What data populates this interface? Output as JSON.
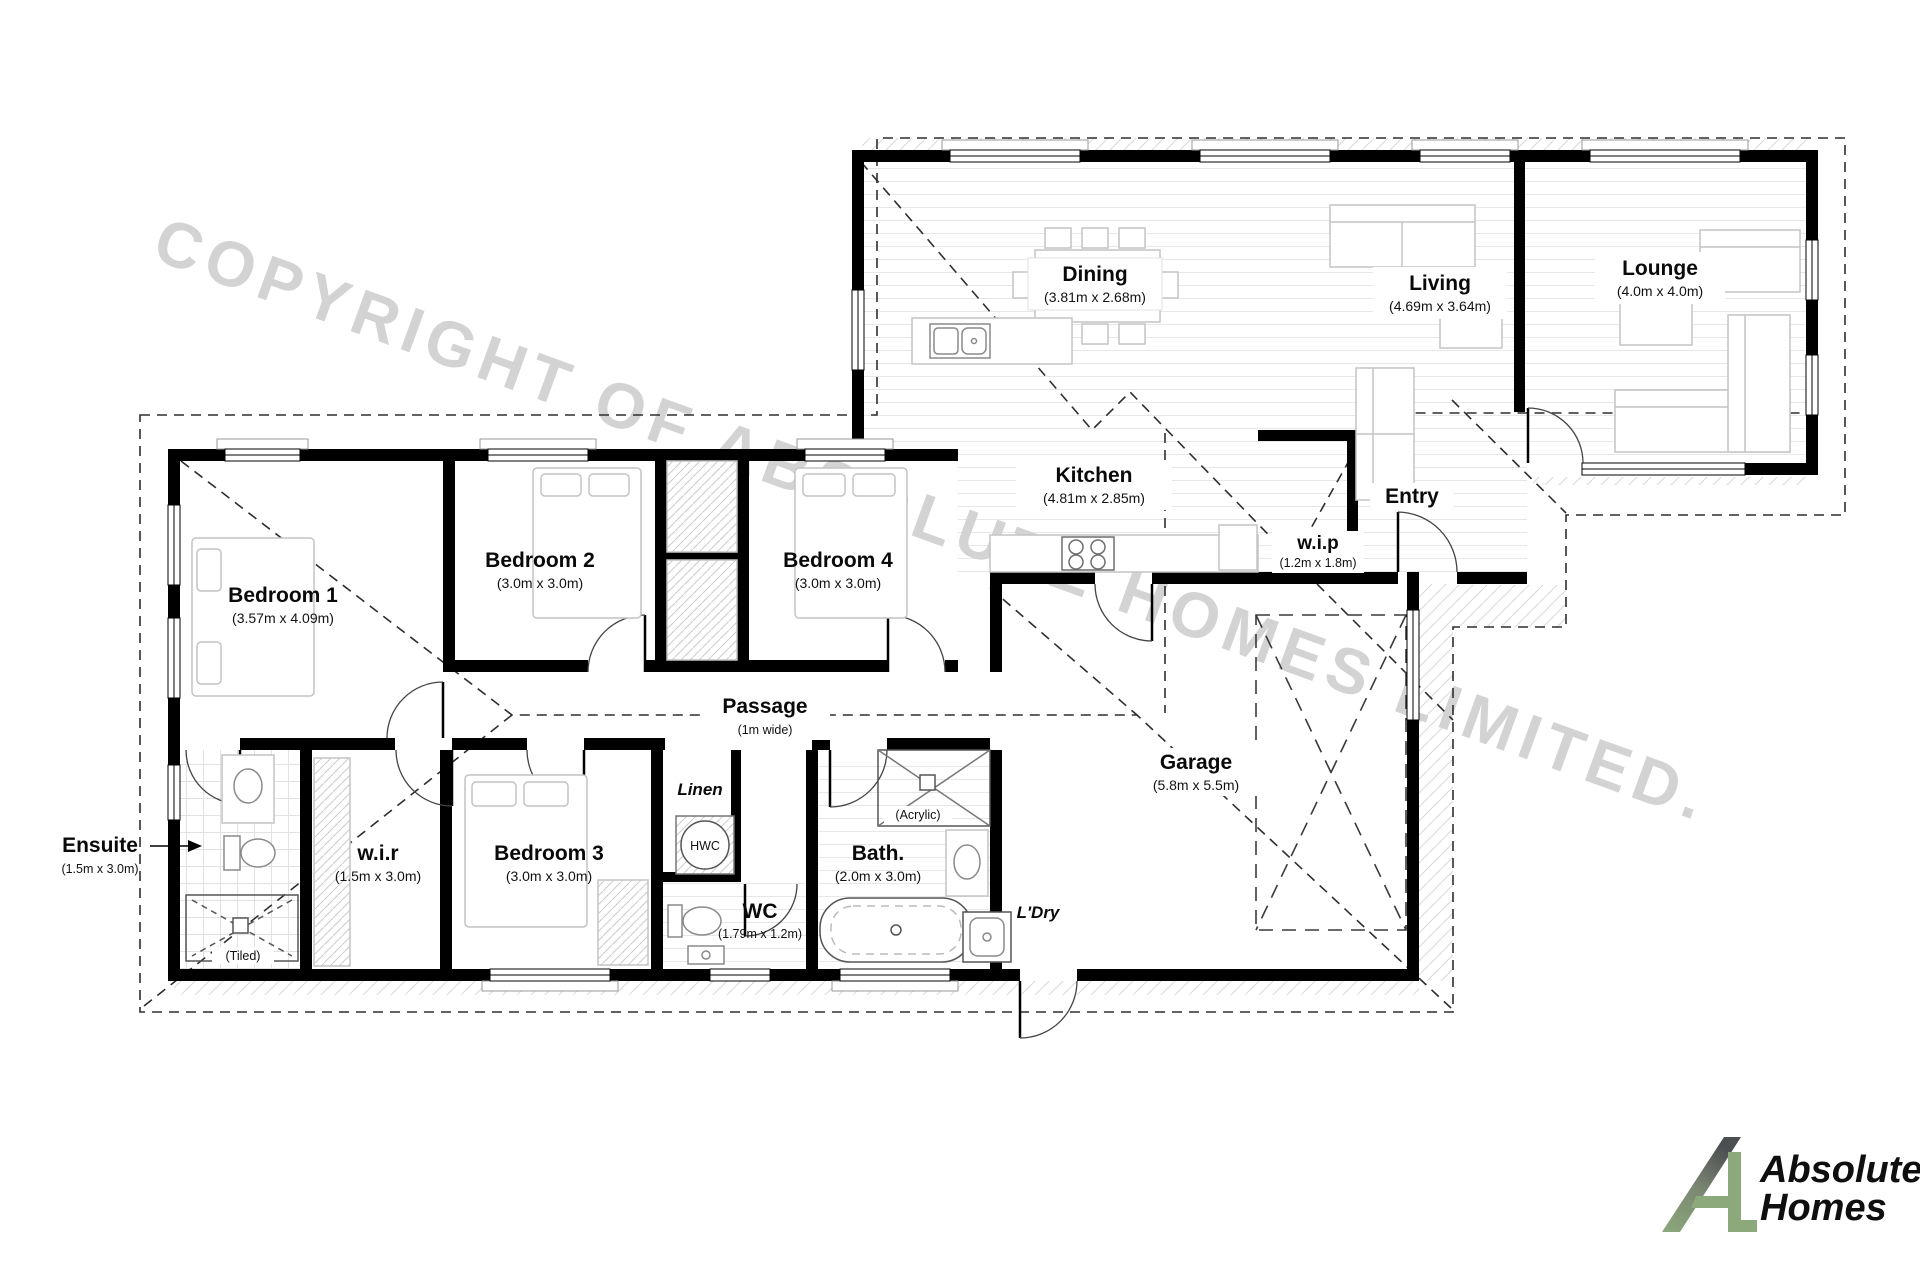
{
  "watermark": "COPYRIGHT OF ABSOLUTE HOMES LIMITED.",
  "logo": {
    "line1": "Absolute",
    "line2": "Homes",
    "green": "#8ca97c",
    "dark": "#4c4f52"
  },
  "rooms": {
    "dining": {
      "name": "Dining",
      "dims": "(3.81m x 2.68m)"
    },
    "living": {
      "name": "Living",
      "dims": "(4.69m x 3.64m)"
    },
    "lounge": {
      "name": "Lounge",
      "dims": "(4.0m x 4.0m)"
    },
    "kitchen": {
      "name": "Kitchen",
      "dims": "(4.81m x 2.85m)"
    },
    "entry": {
      "name": "Entry"
    },
    "wip": {
      "name": "w.i.p",
      "dims": "(1.2m x 1.8m)"
    },
    "bedroom1": {
      "name": "Bedroom 1",
      "dims": "(3.57m x 4.09m)"
    },
    "bedroom2": {
      "name": "Bedroom 2",
      "dims": "(3.0m x 3.0m)"
    },
    "bedroom4": {
      "name": "Bedroom 4",
      "dims": "(3.0m x 3.0m)"
    },
    "passage": {
      "name": "Passage",
      "dims": "(1m wide)"
    },
    "ensuite": {
      "name": "Ensuite",
      "dims": "(1.5m x 3.0m)"
    },
    "wir": {
      "name": "w.i.r",
      "dims": "(1.5m x 3.0m)"
    },
    "bedroom3": {
      "name": "Bedroom 3",
      "dims": "(3.0m x 3.0m)"
    },
    "linen": {
      "name": "Linen"
    },
    "hwc": {
      "name": "HWC"
    },
    "wc": {
      "name": "WC",
      "dims": "(1.79m x 1.2m)"
    },
    "bath": {
      "name": "Bath.",
      "dims": "(2.0m x 3.0m)"
    },
    "ldry": {
      "name": "L'Dry"
    },
    "garage": {
      "name": "Garage",
      "dims": "(5.8m x 5.5m)"
    },
    "tiled_note": "(Tiled)",
    "acrylic_note": "(Acrylic)"
  }
}
